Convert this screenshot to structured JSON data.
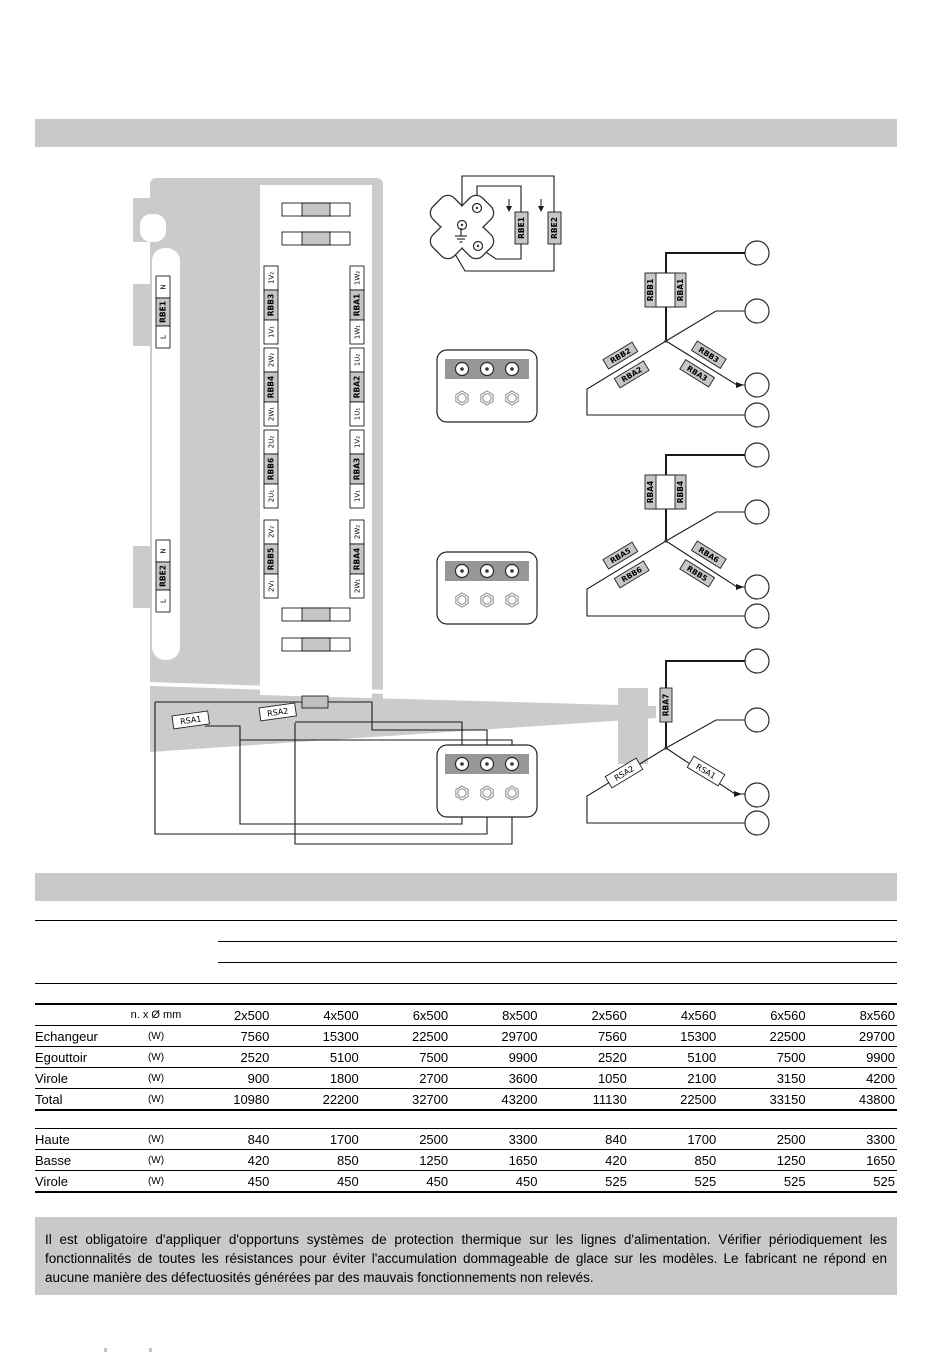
{
  "diagram": {
    "edge_labels": [
      {
        "top": "N",
        "name": "RBE1",
        "bottom": "L"
      },
      {
        "top": "N",
        "name": "RBE2",
        "bottom": "L"
      }
    ],
    "panel_labels": {
      "left": [
        {
          "t2": "1V₂",
          "name": "RBB3",
          "t1": "1V₁"
        },
        {
          "t2": "2W₂",
          "name": "RBB4",
          "t1": "2W₁"
        },
        {
          "t2": "2U₂",
          "name": "RBB6",
          "t1": "2U₁"
        },
        {
          "t2": "2V₂",
          "name": "RBB5",
          "t1": "2V₁"
        }
      ],
      "right": [
        {
          "t2": "1W₂",
          "name": "RBA1",
          "t1": "1W₁"
        },
        {
          "t2": "1U₂",
          "name": "RBA2",
          "t1": "1U₁"
        },
        {
          "t2": "1V₂",
          "name": "RBA3",
          "t1": "1V₁"
        },
        {
          "t2": "2W₂",
          "name": "RBA4",
          "t1": "2W₁"
        }
      ]
    },
    "defrost": {
      "r1": "RBE1",
      "r2": "RBE2"
    },
    "tray": {
      "r1": "RSA1",
      "r2": "RSA2"
    },
    "stars": [
      {
        "pair_left": "RBB1",
        "pair_right": "RBA1",
        "left_upper": "RBB2",
        "left_lower": "RBA2",
        "right_upper": "RBB3",
        "right_lower": "RBA3"
      },
      {
        "pair_left": "RBA4",
        "pair_right": "RBB4",
        "left_upper": "RBA5",
        "left_lower": "RBB6",
        "right_upper": "RBA6",
        "right_lower": "RBB5"
      },
      {
        "top": "RBA7",
        "left": "RSA2",
        "right": "RSA1"
      }
    ]
  },
  "table": {
    "size_header": "n. x Ø mm",
    "unit": "(W)",
    "columns": [
      "2x500",
      "4x500",
      "6x500",
      "8x500",
      "2x560",
      "4x560",
      "6x560",
      "8x560"
    ],
    "group1": [
      {
        "label": "Echangeur",
        "values": [
          "7560",
          "15300",
          "22500",
          "29700",
          "7560",
          "15300",
          "22500",
          "29700"
        ]
      },
      {
        "label": "Egouttoir",
        "values": [
          "2520",
          "5100",
          "7500",
          "9900",
          "2520",
          "5100",
          "7500",
          "9900"
        ]
      },
      {
        "label": "Virole",
        "values": [
          "900",
          "1800",
          "2700",
          "3600",
          "1050",
          "2100",
          "3150",
          "4200"
        ]
      },
      {
        "label": "Total",
        "values": [
          "10980",
          "22200",
          "32700",
          "43200",
          "11130",
          "22500",
          "33150",
          "43800"
        ]
      }
    ],
    "group2": [
      {
        "label": "Haute",
        "values": [
          "840",
          "1700",
          "2500",
          "3300",
          "840",
          "1700",
          "2500",
          "3300"
        ]
      },
      {
        "label": "Basse",
        "values": [
          "420",
          "850",
          "1250",
          "1650",
          "420",
          "850",
          "1250",
          "1650"
        ]
      },
      {
        "label": "Virole",
        "values": [
          "450",
          "450",
          "450",
          "450",
          "525",
          "525",
          "525",
          "525"
        ]
      }
    ]
  },
  "note": "Il est obligatoire d'appliquer d'opportuns systèmes de protection thermique sur les lignes d'alimentation. Vérifier périodiquement les fonctionnalités de toutes les résistances pour éviter l'accumulation dommageable de glace sur les modèles. Le fabricant ne répond en aucune manière des défectuosités générées par des mauvais fonctionnements non relevés."
}
